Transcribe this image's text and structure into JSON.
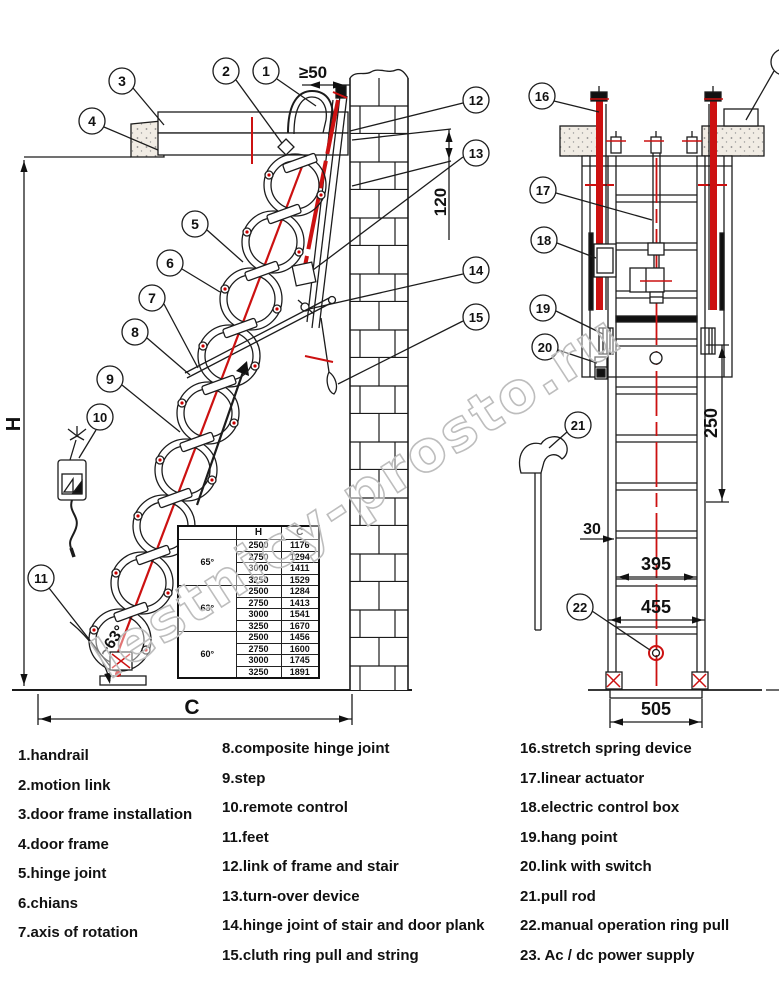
{
  "watermark": "lestnicy-prosto.ru",
  "callouts": [
    "1",
    "2",
    "3",
    "4",
    "5",
    "6",
    "7",
    "8",
    "9",
    "10",
    "11",
    "12",
    "13",
    "14",
    "15",
    "16",
    "17",
    "18",
    "19",
    "20",
    "21",
    "22",
    "23"
  ],
  "dims": {
    "gap": "≥50",
    "depth": "120",
    "H": "H",
    "C": "C",
    "angle": "~63°",
    "rung": "250",
    "stile": "30",
    "inner": "395",
    "outer": "455",
    "base": "505"
  },
  "table": {
    "headers": [
      "",
      "H",
      "C"
    ],
    "groups": [
      {
        "angle": "65°",
        "rows": [
          [
            2500,
            1176
          ],
          [
            2750,
            1294
          ],
          [
            3000,
            1411
          ],
          [
            3250,
            1529
          ]
        ]
      },
      {
        "angle": "63°",
        "rows": [
          [
            2500,
            1284
          ],
          [
            2750,
            1413
          ],
          [
            3000,
            1541
          ],
          [
            3250,
            1670
          ]
        ]
      },
      {
        "angle": "60°",
        "rows": [
          [
            2500,
            1456
          ],
          [
            2750,
            1600
          ],
          [
            3000,
            1745
          ],
          [
            3250,
            1891
          ]
        ]
      }
    ]
  },
  "legend": {
    "col1": [
      "1.handrail",
      "2.motion link",
      "3.door frame installation",
      "4.door frame",
      "5.hinge joint",
      "6.chians",
      "7.axis of rotation"
    ],
    "col2": [
      "8.composite hinge joint",
      "9.step",
      "10.remote control",
      "11.feet",
      "12.link of frame and stair",
      "13.turn-over device",
      "14.hinge joint of stair and door plank",
      "15.cluth ring pull and string"
    ],
    "col3": [
      "16.stretch spring device",
      "17.linear actuator",
      "18.electric control box",
      "19.hang point",
      "20.link with switch",
      "21.pull rod",
      "22.manual operation ring pull",
      "23. Ac / dc power supply"
    ]
  },
  "colors": {
    "accent_red": "#cc1111",
    "line": "#1c1c1c",
    "watermark": "#bdbdbd"
  }
}
